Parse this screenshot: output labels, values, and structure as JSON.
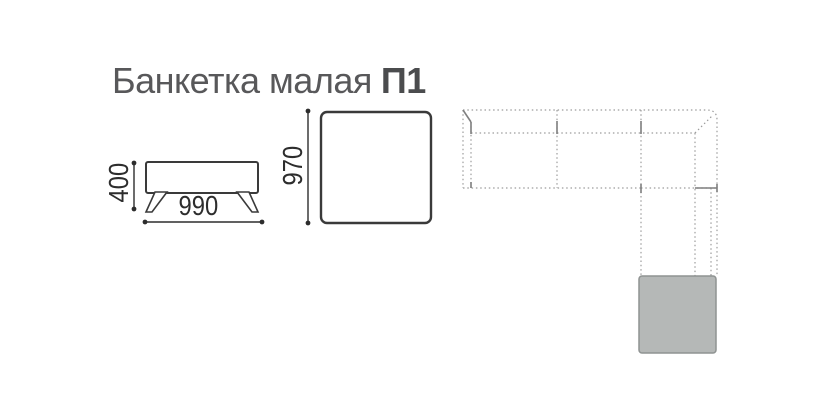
{
  "product": {
    "title": "Банкетка малая",
    "model_code": "П1",
    "dimensions": {
      "height_mm": "400",
      "width_mm": "990",
      "depth_mm": "970"
    }
  },
  "schematic": {
    "description": "sectional-sofa-layout-with-highlighted-bench-module",
    "highlighted_module": "corner-chaise-end"
  },
  "colors": {
    "title_text": "#58585a",
    "dimension_text": "#2d2d2d",
    "drawing_line": "#3a3a3a",
    "schematic_dashed_line": "#9c9c9c",
    "schematic_solid_tick": "#7f7f7f",
    "highlight_module_fill": "#b5b8b7",
    "highlight_module_border": "#8f9392",
    "background": "#ffffff"
  }
}
